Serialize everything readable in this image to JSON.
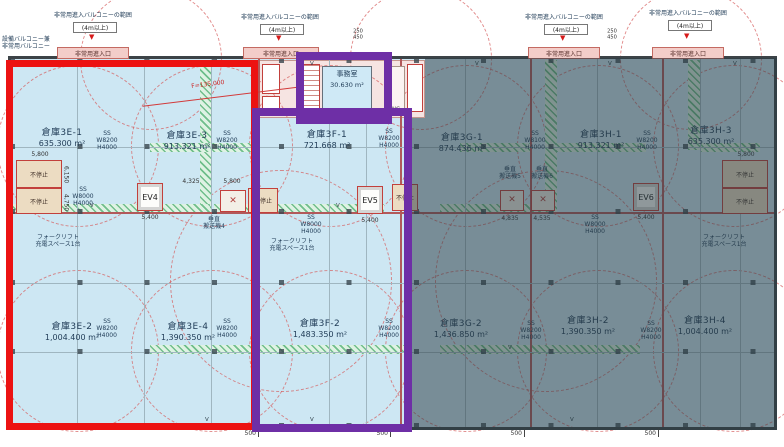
{
  "plan": {
    "balcony_note": "設備バルコニー兼\n非常用バルコニー",
    "range_label": "非常用進入バルコニーの範囲",
    "range_min": "(4m以上)",
    "entry_label": "非常用進入口",
    "office": {
      "name": "事務室",
      "area": "30.630 m²"
    },
    "wc": "WC",
    "rooms": [
      {
        "name": "倉庫3E-1",
        "area": "635.300 m²"
      },
      {
        "name": "倉庫3E-3",
        "area": "913.321 m²"
      },
      {
        "name": "倉庫3F-1",
        "area": "721.668 m²"
      },
      {
        "name": "倉庫3G-1",
        "area": "874.436 m²"
      },
      {
        "name": "倉庫3H-1",
        "area": "913.321 m²"
      },
      {
        "name": "倉庫3H-3",
        "area": "635.300 m²"
      },
      {
        "name": "倉庫3E-2",
        "area": "1,004.400 m²"
      },
      {
        "name": "倉庫3E-4",
        "area": "1,390.350 m²"
      },
      {
        "name": "倉庫3F-2",
        "area": "1,483.350 m²"
      },
      {
        "name": "倉庫3G-2",
        "area": "1,436.850 m²"
      },
      {
        "name": "倉庫3H-2",
        "area": "1,390.350 m²"
      },
      {
        "name": "倉庫3H-4",
        "area": "1,004.400 m²"
      }
    ],
    "elevators": [
      "EV4",
      "EV5",
      "EV6"
    ],
    "no_stop": "不停止",
    "conveyors": [
      "垂直\n搬送機4",
      "垂直\n搬送機5",
      "垂直\n搬送機6"
    ],
    "forklift": "フォークリフト\n充電スペース1台",
    "shutters": {
      "w8200": "SS\nW8200\nH4000",
      "w8100": "SS\nW8100\nH4000",
      "w8000": "SS\nW8000\nH4000"
    },
    "dims": {
      "d500": "500",
      "d5400": "5,400",
      "d5800": "5,800",
      "d4325": "4,325",
      "d4835": "4,835",
      "d4535": "4,535",
      "d6150": "6,150",
      "d4750": "4,750",
      "d250_450": "250\n450",
      "f135": "F=135,000"
    },
    "marks": {
      "v": "V",
      "x": "✕",
      "tri": "▼"
    },
    "colors": {
      "highlight_red": "#ec1212",
      "highlight_purple": "#6e2fa6",
      "floor_blue": "#cde7f3",
      "dim_overlay": "rgba(42,59,68,0.52)"
    }
  }
}
